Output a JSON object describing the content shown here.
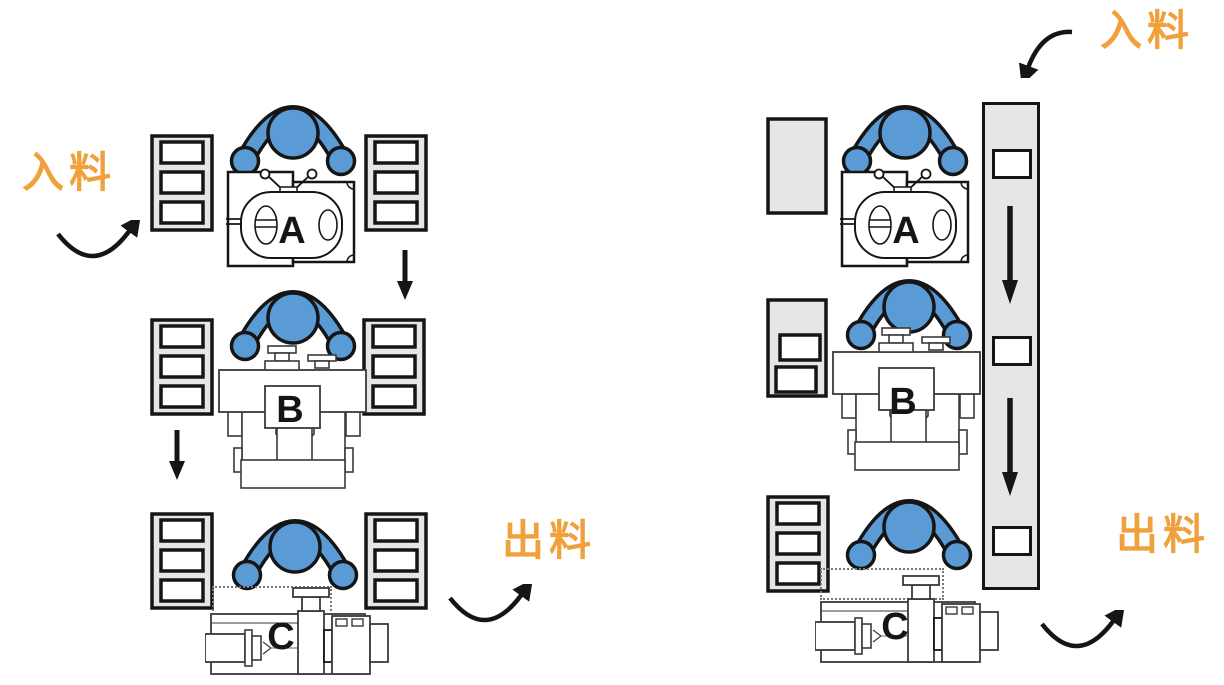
{
  "left_layout": {
    "input_label": "入料",
    "output_label": "出料",
    "machine_a_label": "A",
    "machine_b_label": "B",
    "machine_c_label": "C"
  },
  "right_layout": {
    "input_label": "入料",
    "output_label": "出料",
    "machine_a_label": "A",
    "machine_b_label": "B",
    "machine_c_label": "C"
  },
  "colors": {
    "worker_blue": "#5B9BD5",
    "equipment_gray": "#E7E6E6",
    "flow_label_orange": "#F0A13C",
    "line_black": "#151515",
    "background": "#FFFFFF"
  }
}
